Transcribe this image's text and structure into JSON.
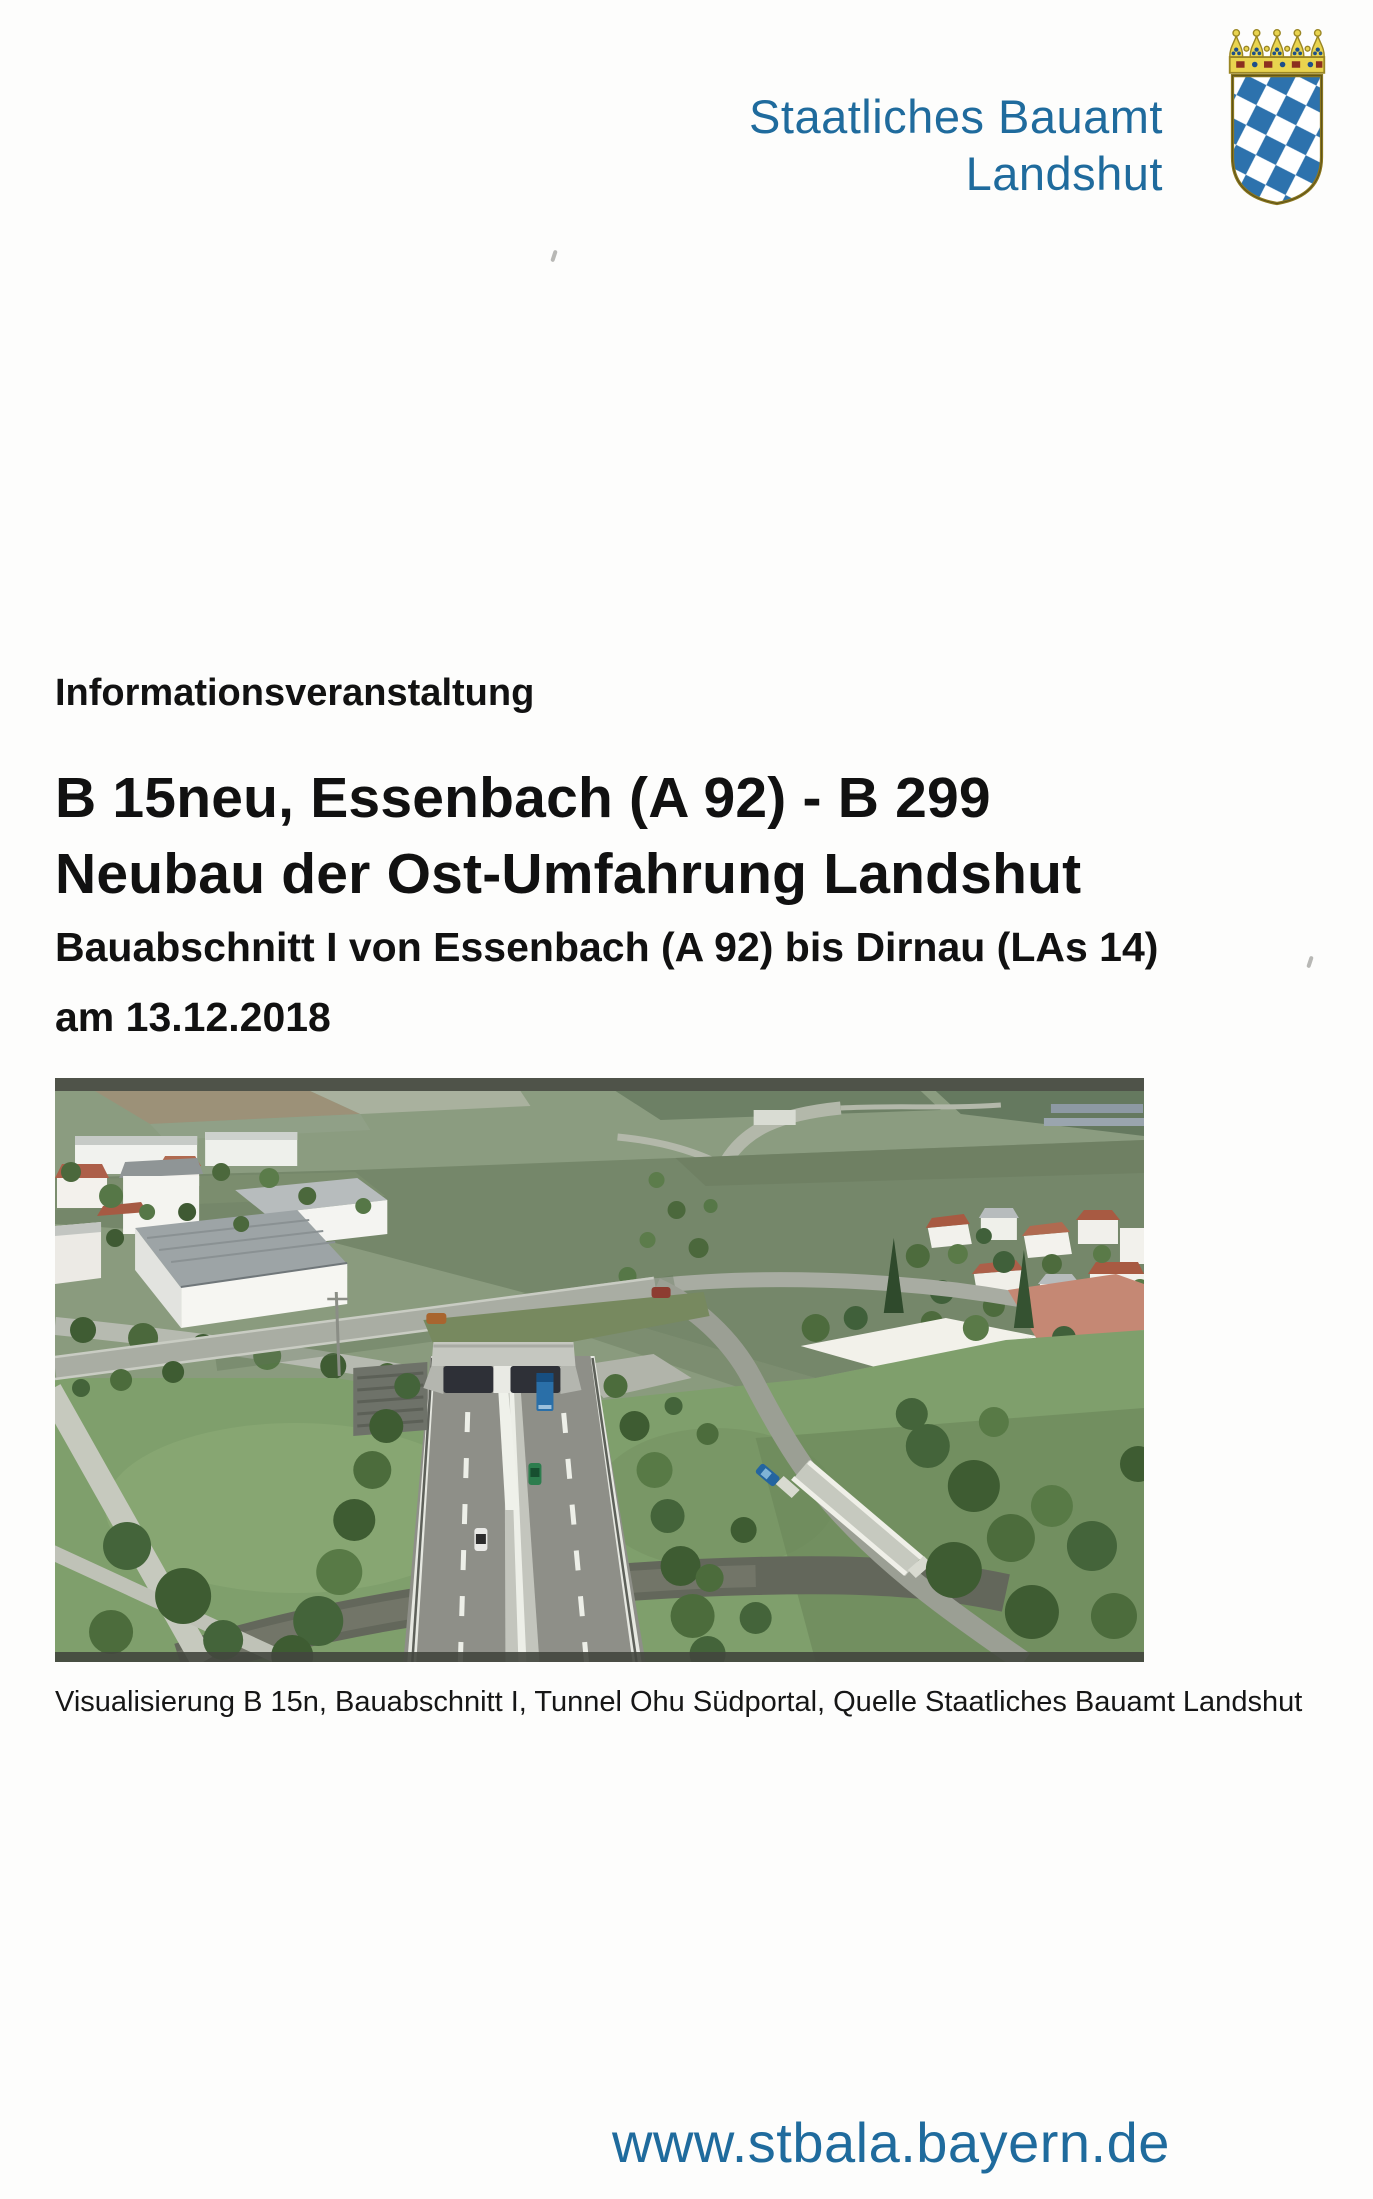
{
  "header": {
    "agency_line1": "Staatliches Bauamt",
    "agency_line2": "Landshut",
    "emblem_icon": "bavarian-coat-of-arms",
    "accent_color": "#1f6b9d"
  },
  "content": {
    "kicker": "Informationsveranstaltung",
    "title_line1": "B 15neu, Essenbach (A 92) - B 299",
    "title_line2": "Neubau der Ost-Umfahrung Landshut",
    "subtitle": "Bauabschnitt I von Essenbach (A 92) bis Dirnau (LAs 14)",
    "date_line": "am 13.12.2018"
  },
  "figure": {
    "image_name": "aerial-3d-visualization-tunnel-ohu-suedportal",
    "caption": "Visualisierung B 15n, Bauabschnitt I, Tunnel Ohu Südportal, Quelle Staatliches Bauamt Landshut"
  },
  "footer": {
    "website": "www.stbala.bayern.de"
  }
}
